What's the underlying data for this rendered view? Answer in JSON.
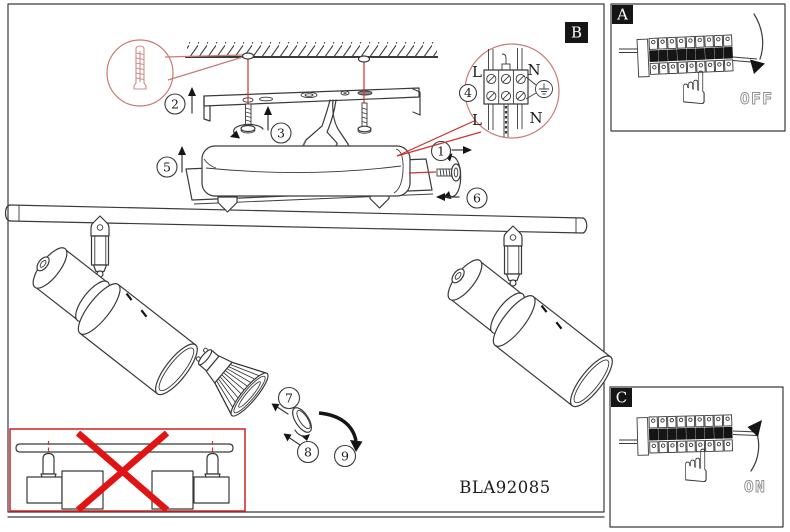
{
  "product_code": "BLA92085",
  "steps": {
    "s1": "1",
    "s2": "2",
    "s3": "3",
    "s4": "4",
    "s5": "5",
    "s6": "6",
    "s7": "7",
    "s8": "8",
    "s9": "9"
  },
  "details": {
    "a": "A",
    "b": "B",
    "c": "C"
  },
  "terminals": {
    "top_left": "L",
    "top_right": "N",
    "bottom_left": "L",
    "bottom_right": "N"
  },
  "breaker": {
    "off": "OFF",
    "on": "ON"
  },
  "colors": {
    "line": "#3a3a3a",
    "accent_red": "#cc3333",
    "detail_circle_red": "#c97b74",
    "cross_red": "#e01414",
    "muted_text": "#8f8f8f"
  }
}
